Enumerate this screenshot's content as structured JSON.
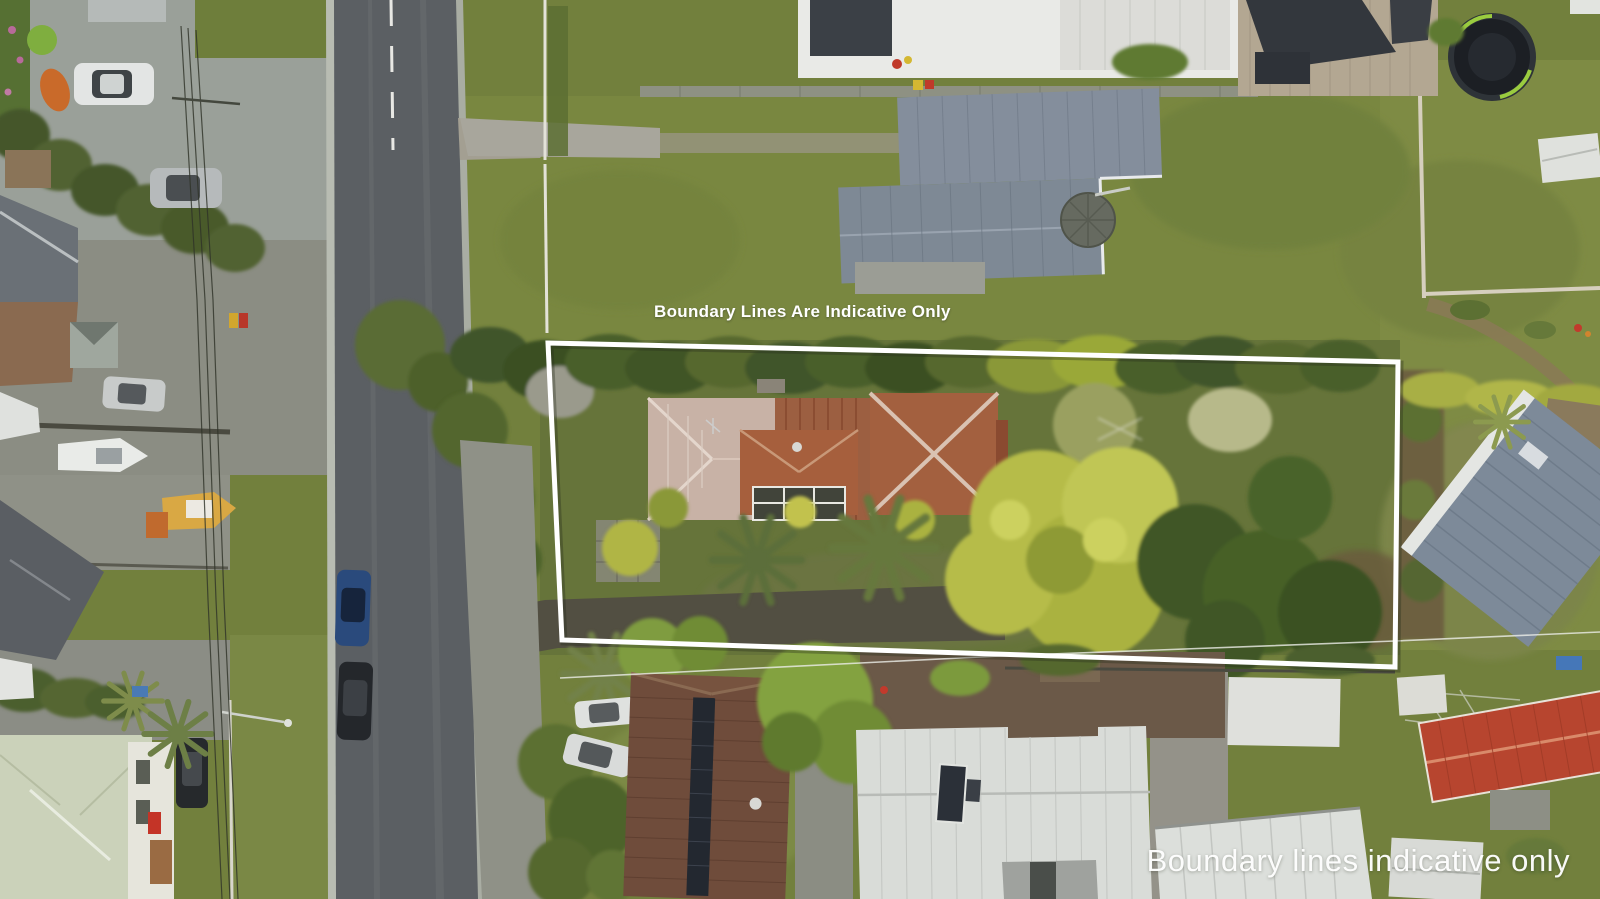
{
  "meta": {
    "description": "Aerial drone photograph of a residential street block; a long rear section containing an old rust-roofed house, palms and large trees is outlined with a white indicative boundary overlay."
  },
  "captions": {
    "top": "Boundary Lines Are Indicative Only",
    "bottom": "Boundary lines indicative only"
  },
  "boundary": {
    "stroke_color": "#ffffff",
    "points": "548,343 1398,362 1395,667 562,640"
  },
  "palette": {
    "lawn_base": "#72803d",
    "lawn_bright": "#7f8b44",
    "lawn_shaded": "#66743a",
    "asphalt": "#5b5f63",
    "concrete": "#9aa099",
    "gravel": "#8d9086",
    "driveway_moss": "#524f42",
    "hedge_dark": "#41552a",
    "tree_chartreuse": "#b6bc4a",
    "palm_green": "#6d7f46",
    "roof_rust": "#9c5f41",
    "roof_weathered": "#c8b2a6",
    "roof_slate": "#7e8995",
    "roof_charcoal": "#33373d",
    "roof_white": "#d9dcd8",
    "roof_red_tile": "#b7452f",
    "roof_brown_tile": "#6f4c3b",
    "roof_pale_green": "#cbd2ba",
    "boat_yellow": "#d9a844",
    "car_blue": "#2a4a7c",
    "car_black": "#24272b",
    "car_white": "#e3e5e4",
    "caption_white": "#ffffff"
  },
  "scene_objects": [
    "asphalt-street",
    "gravel-side-road",
    "heritage-house-rusty-roof",
    "conservatory-glass-roof",
    "palm-trees",
    "chartreuse-tree",
    "boundary-hedge",
    "gray-gable-house",
    "round-gazebo",
    "trampoline",
    "white-suv",
    "silver-hatchback",
    "blue-sedan",
    "black-sedan",
    "black-suv",
    "white-boat-on-trailer",
    "yellow-boat",
    "brown-tile-roof-with-solar-panels",
    "white-flat-roof-house",
    "red-tile-roof-house",
    "pale-green-hip-roof-house",
    "power-lines",
    "street-light"
  ]
}
